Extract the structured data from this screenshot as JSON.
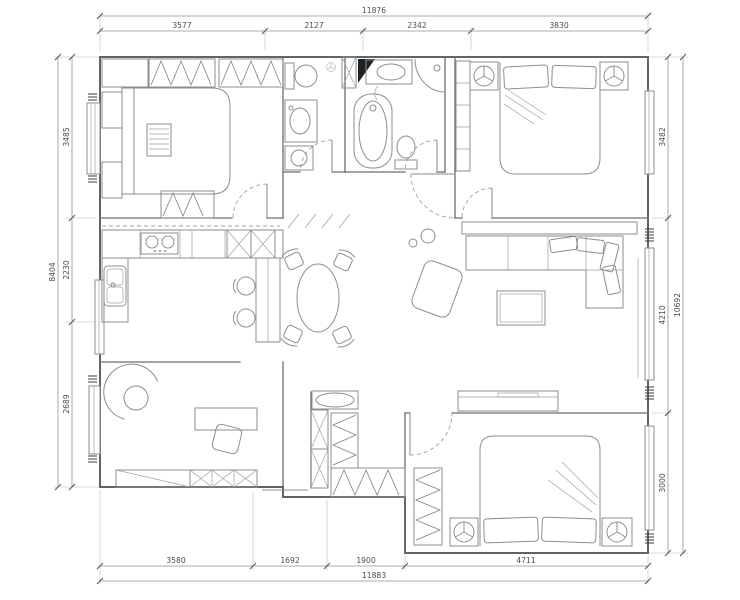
{
  "drawing": {
    "kind": "apartment-floor-plan",
    "style": "architectural line drawing"
  },
  "colors": {
    "background": "#ffffff",
    "wall_line": "#5f6468",
    "fixture_line": "#8a8e92",
    "dimension_text": "#4a4d50"
  },
  "dimensions": {
    "top": {
      "total": "11876",
      "segments": [
        "3577",
        "2127",
        "2342",
        "3830"
      ]
    },
    "bottom": {
      "total": "11883",
      "segments": [
        "3580",
        "1692",
        "1900",
        "4711"
      ]
    },
    "left": {
      "total": "8404",
      "segments": [
        "3485",
        "2230",
        "2689"
      ]
    },
    "right": {
      "total": "10692",
      "segments": [
        "3482",
        "4210",
        "3000"
      ]
    }
  }
}
